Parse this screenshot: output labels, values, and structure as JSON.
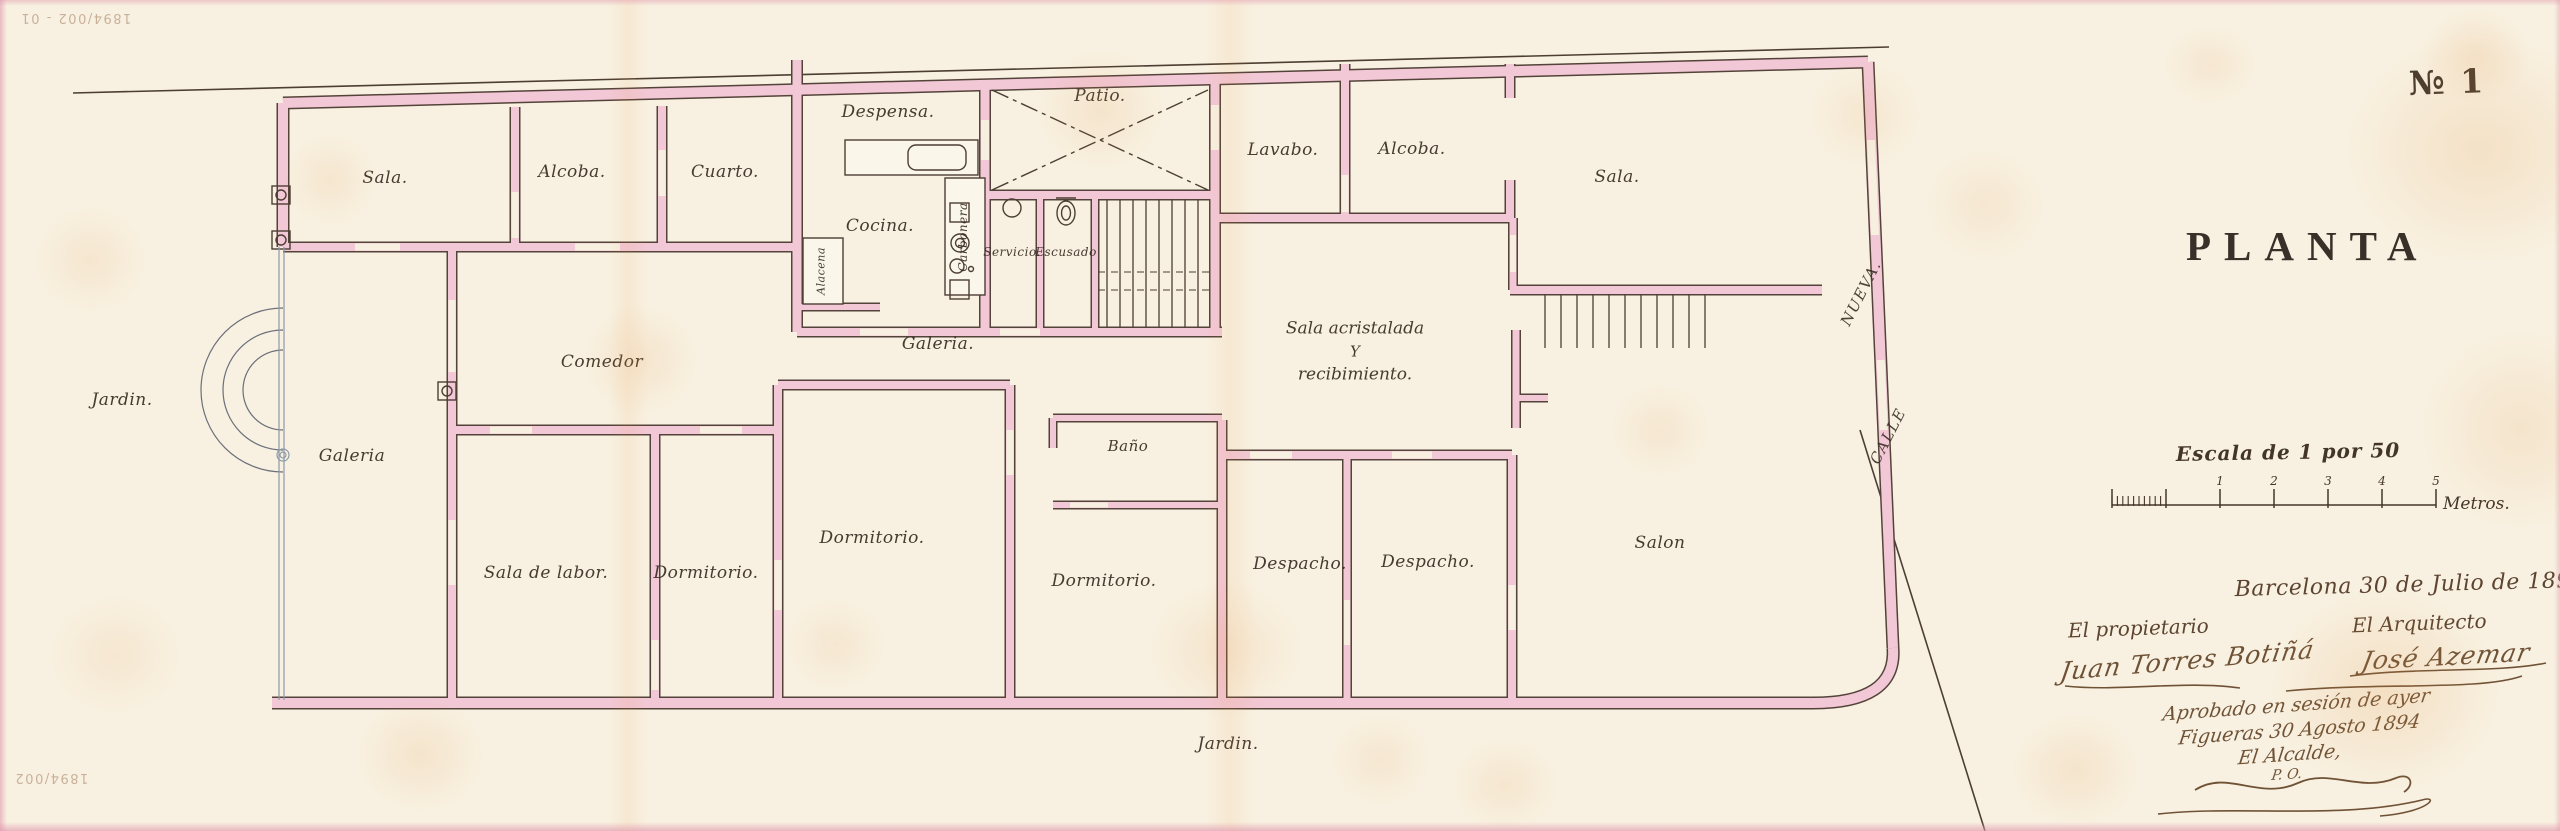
{
  "document": {
    "sheet_number": "№ 1",
    "title": "PLANTA",
    "scale": {
      "heading": "Escala de 1 por 50",
      "unit_label": "Metros.",
      "tick_labels": [
        "1",
        "2",
        "3",
        "4",
        "5"
      ]
    },
    "date_line": "Barcelona 30 de Julio de 1894",
    "owner": {
      "heading": "El propietario",
      "signature": "Juan Torres Botiñá"
    },
    "architect": {
      "heading": "El Arquitecto",
      "signature": "José Azemar"
    },
    "approval": {
      "line1": "Aprobado en sesión de ayer",
      "line2": "Figueras 30 Agosto 1894",
      "line3": "El Alcalde,",
      "line4": "P. O."
    },
    "archive_notes": {
      "top_left": "1894/002 - 01",
      "bottom_left": "1894/002"
    }
  },
  "sala_acristalada": {
    "lines": [
      "Sala acristalada",
      "Y",
      "recibimiento."
    ]
  },
  "streets": [
    {
      "id": "nueva",
      "label": "NUEVA."
    },
    {
      "id": "calle",
      "label": "CALLE"
    }
  ],
  "rooms": [
    {
      "id": "sala-left",
      "label": "Sala."
    },
    {
      "id": "alcoba-left",
      "label": "Alcoba."
    },
    {
      "id": "cuarto",
      "label": "Cuarto."
    },
    {
      "id": "despensa",
      "label": "Despensa."
    },
    {
      "id": "cocina",
      "label": "Cocina."
    },
    {
      "id": "carbonera",
      "label": "Carbonera"
    },
    {
      "id": "alacena",
      "label": "Alacena"
    },
    {
      "id": "patio",
      "label": "Patio."
    },
    {
      "id": "servicio",
      "label": "Servicio."
    },
    {
      "id": "escusado",
      "label": "Escusado"
    },
    {
      "id": "lavabo",
      "label": "Lavabo."
    },
    {
      "id": "alcoba-right",
      "label": "Alcoba."
    },
    {
      "id": "sala-right",
      "label": "Sala."
    },
    {
      "id": "comedor",
      "label": "Comedor"
    },
    {
      "id": "galeria-center",
      "label": "Galeria."
    },
    {
      "id": "jardin-left",
      "label": "Jardin."
    },
    {
      "id": "galeria-left",
      "label": "Galeria"
    },
    {
      "id": "banio",
      "label": "Baño"
    },
    {
      "id": "sala-de-labor",
      "label": "Sala de labor."
    },
    {
      "id": "dormitorio-1",
      "label": "Dormitorio."
    },
    {
      "id": "dormitorio-2",
      "label": "Dormitorio."
    },
    {
      "id": "dormitorio-3",
      "label": "Dormitorio."
    },
    {
      "id": "despacho-1",
      "label": "Despacho."
    },
    {
      "id": "despacho-2",
      "label": "Despacho."
    },
    {
      "id": "salon",
      "label": "Salon"
    },
    {
      "id": "jardin-bottom",
      "label": "Jardin."
    }
  ]
}
